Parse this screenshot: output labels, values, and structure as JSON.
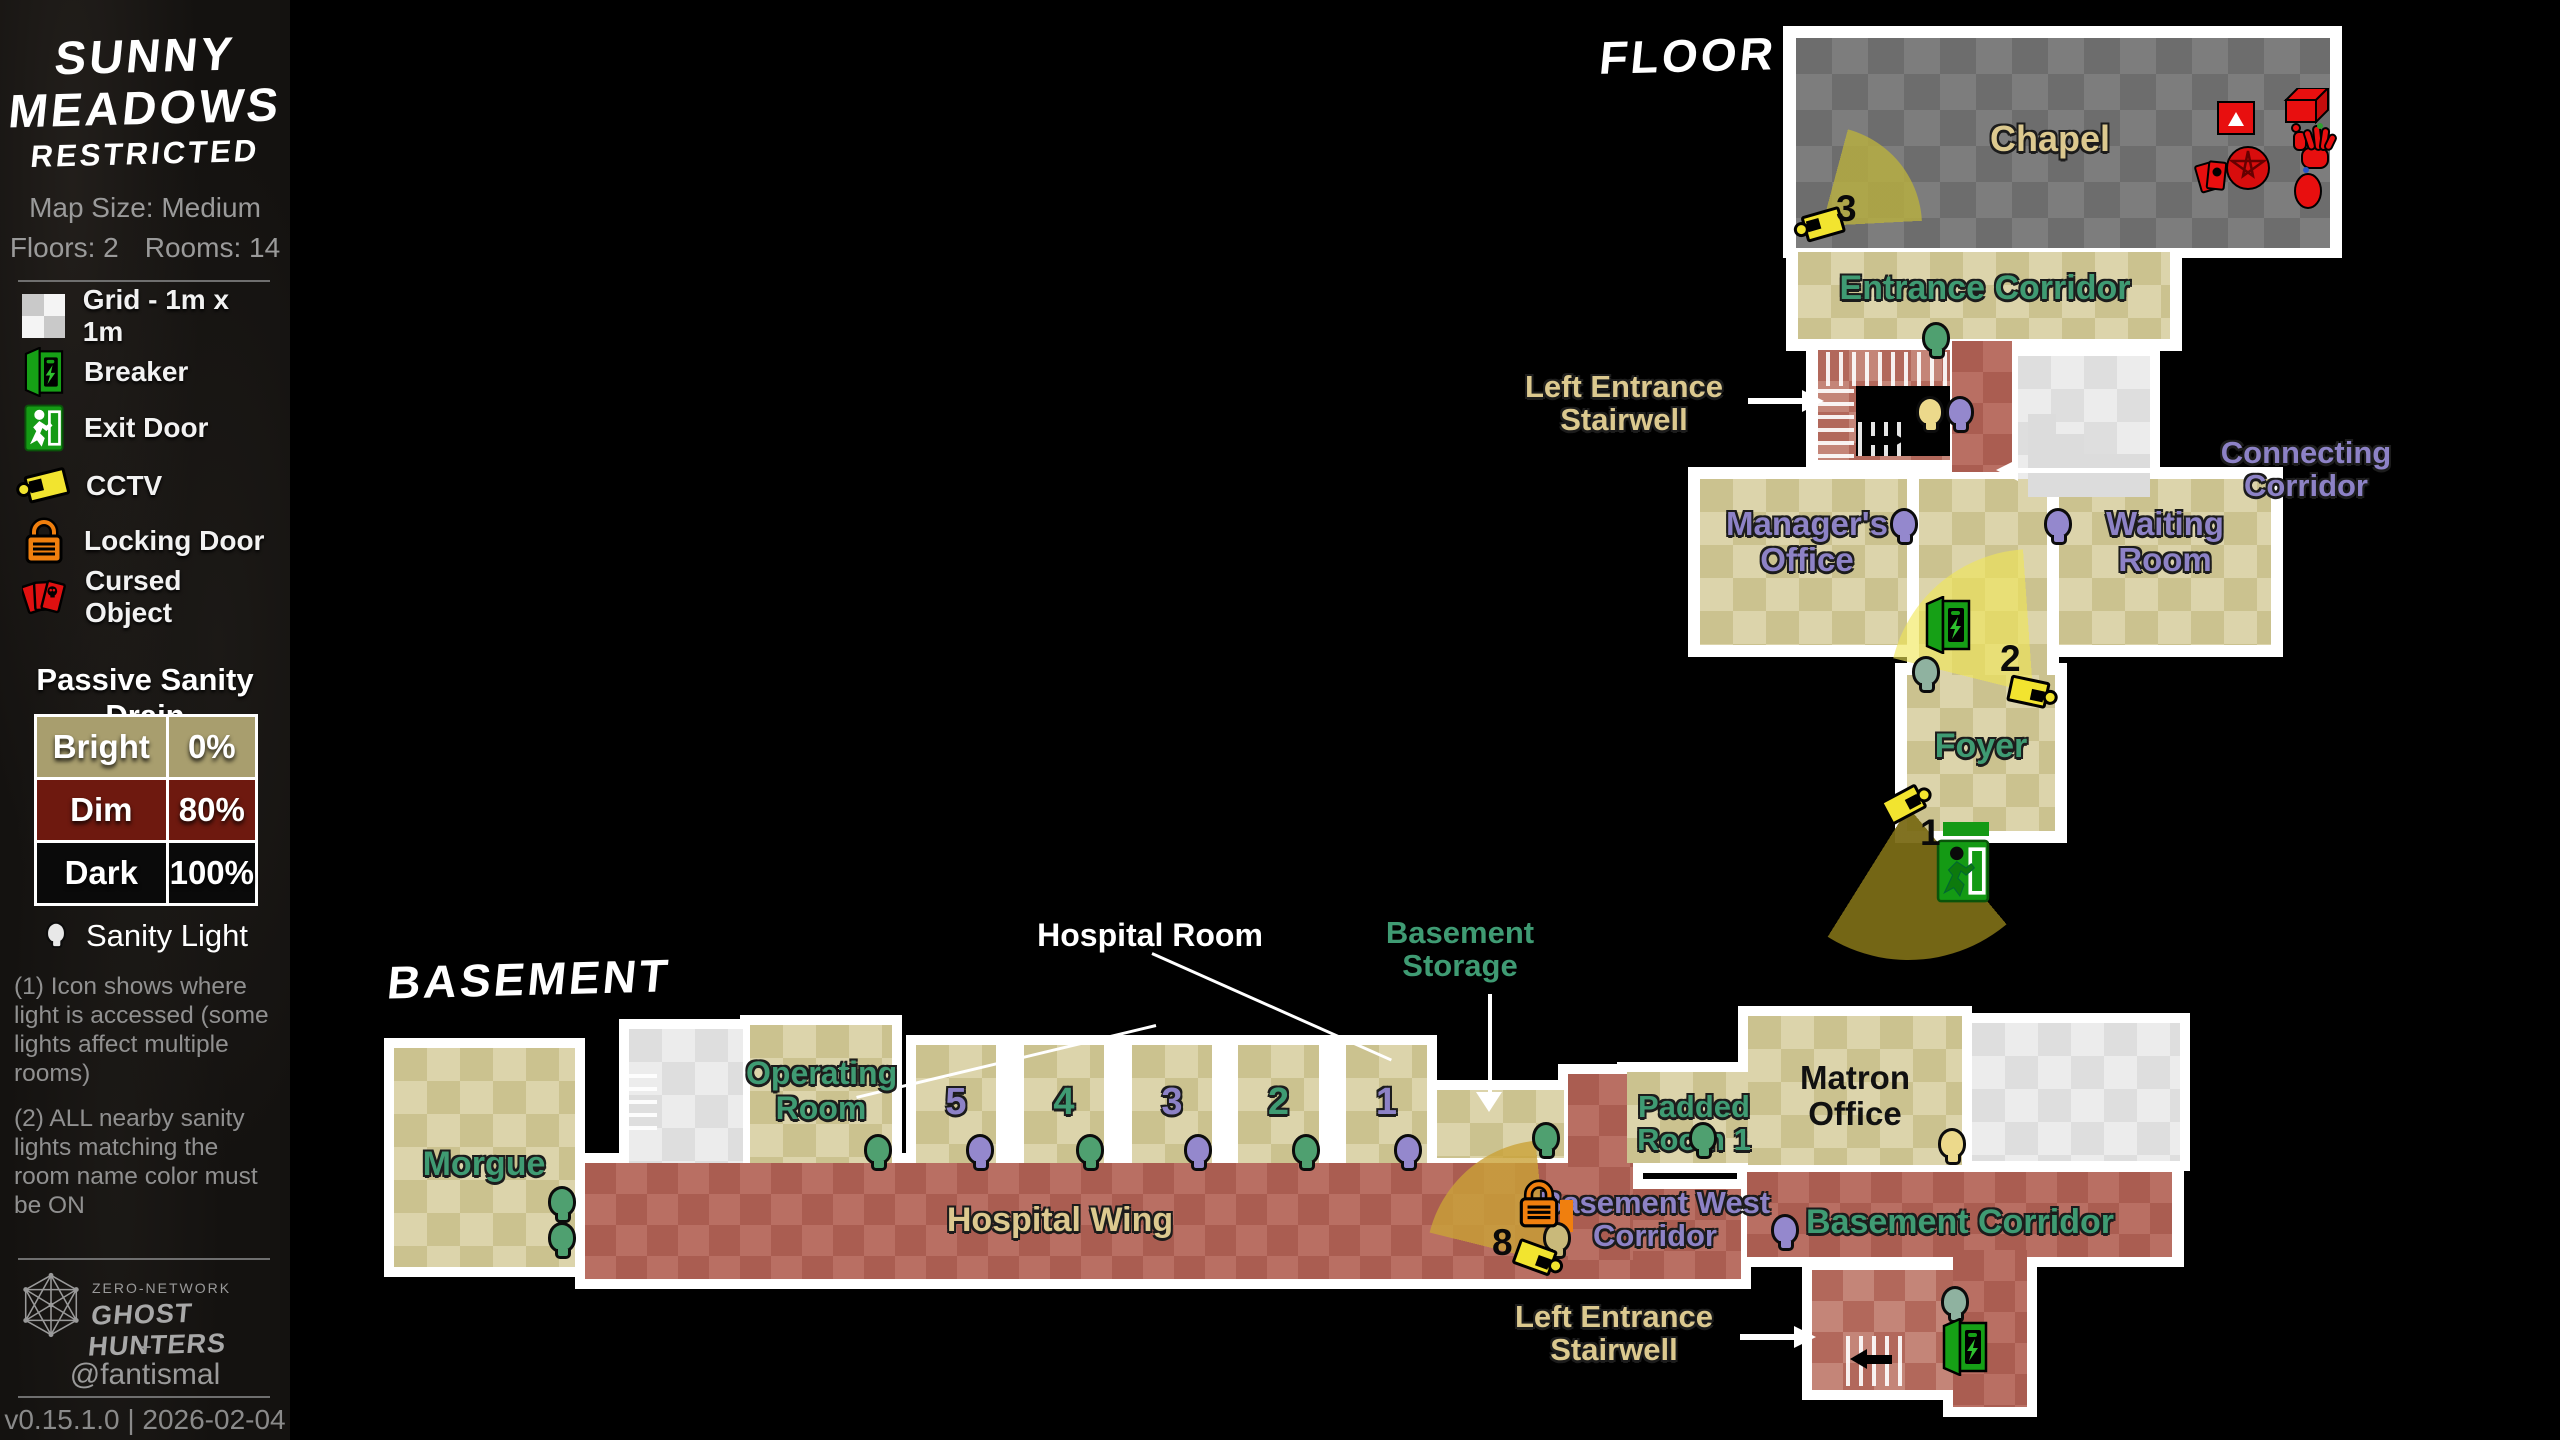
{
  "sidebar": {
    "title1": "SUNNY",
    "title2": "MEADOWS",
    "title3": "RESTRICTED",
    "map_size": "Map Size: Medium",
    "floors": "Floors: 2",
    "rooms": "Rooms: 14",
    "legend": [
      {
        "id": "grid",
        "label": "Grid - 1m x 1m"
      },
      {
        "id": "breaker",
        "label": "Breaker"
      },
      {
        "id": "exit-door",
        "label": "Exit Door"
      },
      {
        "id": "cctv",
        "label": "CCTV"
      },
      {
        "id": "locking-door",
        "label": "Locking Door"
      },
      {
        "id": "cursed-object",
        "label": "Cursed Object"
      }
    ],
    "sanity_drain": {
      "heading": "Passive Sanity Drain",
      "rows": [
        {
          "label": "Bright",
          "value": "0%",
          "color": "#a89e6e"
        },
        {
          "label": "Dim",
          "value": "80%",
          "color": "#6e190f"
        },
        {
          "label": "Dark",
          "value": "100%",
          "color": "#0a0a0a"
        }
      ]
    },
    "sanity_light": {
      "heading": "Sanity Light",
      "note1": "(1) Icon shows where light is accessed (some lights affect multiple rooms)",
      "note2": "(2) ALL nearby sanity lights matching the room name color must be ON"
    },
    "footer": {
      "network": "ZERO-NETWORK",
      "brand": "GHOST HUNTERS",
      "plus": "+",
      "handle": "@fantismal",
      "version": "v0.15.1.0 | 2026-02-04"
    }
  },
  "floor1": {
    "title": "FLOOR 1",
    "chapel": "Chapel",
    "entrance_corridor": "Entrance Corridor",
    "managers_office": "Manager's Office",
    "waiting_room": "Waiting Room",
    "foyer": "Foyer",
    "left_entrance_stairwell": "Left Entrance Stairwell",
    "connecting_corridor": "Connecting Corridor",
    "cam3": "3",
    "cam2": "2",
    "cam1": "1"
  },
  "basement": {
    "title": "BASEMENT",
    "morgue": "Morgue",
    "operating_room": "Operating Room",
    "room5": "5",
    "room4": "4",
    "room3": "3",
    "room2": "2",
    "room1": "1",
    "hospital_wing": "Hospital Wing",
    "hospital_room_label": "Hospital Room",
    "basement_storage": "Basement Storage",
    "padded_room1": "Padded Room 1",
    "matron_office": "Matron Office",
    "basement_west_corridor": "Basement West Corridor",
    "basement_corridor": "Basement Corridor",
    "left_entrance_stairwell": "Left Entrance Stairwell",
    "cam8": "8"
  },
  "colors": {
    "accent_green": "#3f9b73",
    "accent_purple": "#8d82c6",
    "accent_khaki": "#dcc98f",
    "camera_yellow": "#f2e42f",
    "lock_orange": "#f07f0e",
    "cursed_red": "#e01010",
    "breaker_green": "#16a016"
  }
}
